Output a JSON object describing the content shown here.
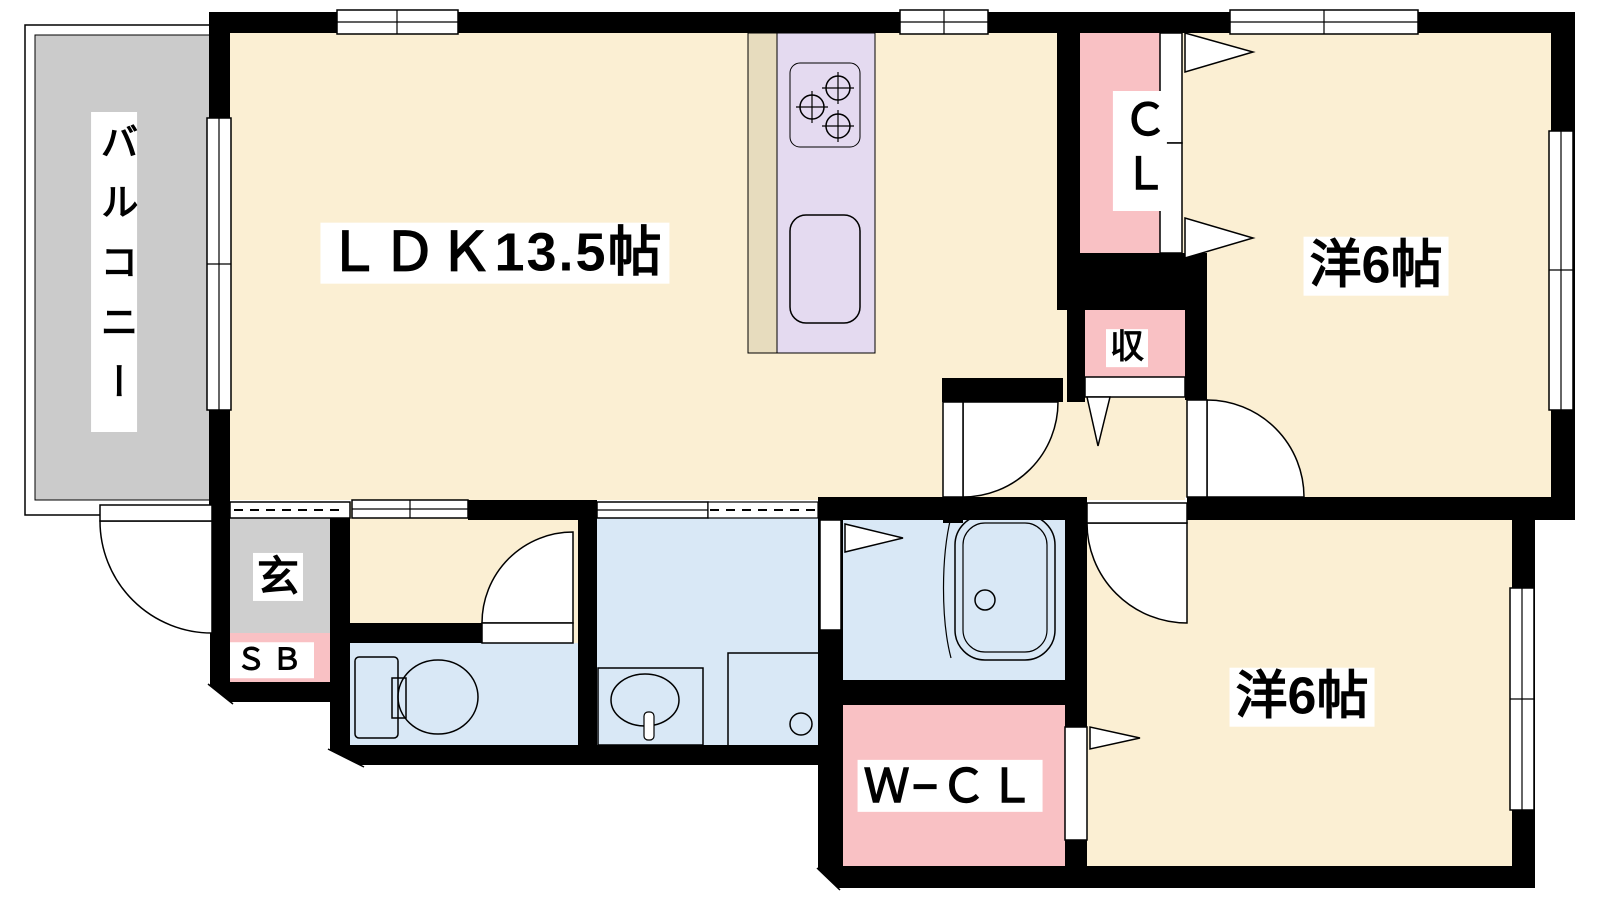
{
  "title": "2LDK apartment floor plan",
  "colors": {
    "room": "#FBEFD3",
    "closet_pink": "#F9C1C4",
    "wet_blue": "#D9E8F6",
    "kitchen_lavender": "#E4DAF0",
    "counter_beige": "#E7DCBE",
    "balcony_gray": "#CBCBCB",
    "genkan_gray": "#CFCFCF",
    "wall": "#000000",
    "label_bg": "#FFFFFF",
    "label_text": "#000000"
  },
  "rooms": {
    "balcony": {
      "label": "バルコニー"
    },
    "ldk": {
      "label": "ＬＤＫ13.5帖"
    },
    "bedroom_top": {
      "label": "洋6帖"
    },
    "bedroom_bottom": {
      "label": "洋6帖"
    },
    "closet_cl": {
      "label": "ＣＬ"
    },
    "storage": {
      "label": "収"
    },
    "entrance": {
      "label": "玄"
    },
    "shoe_box": {
      "label": "ＳＢ"
    },
    "walk_in_closet": {
      "label": "Ｗ−ＣＬ"
    }
  }
}
